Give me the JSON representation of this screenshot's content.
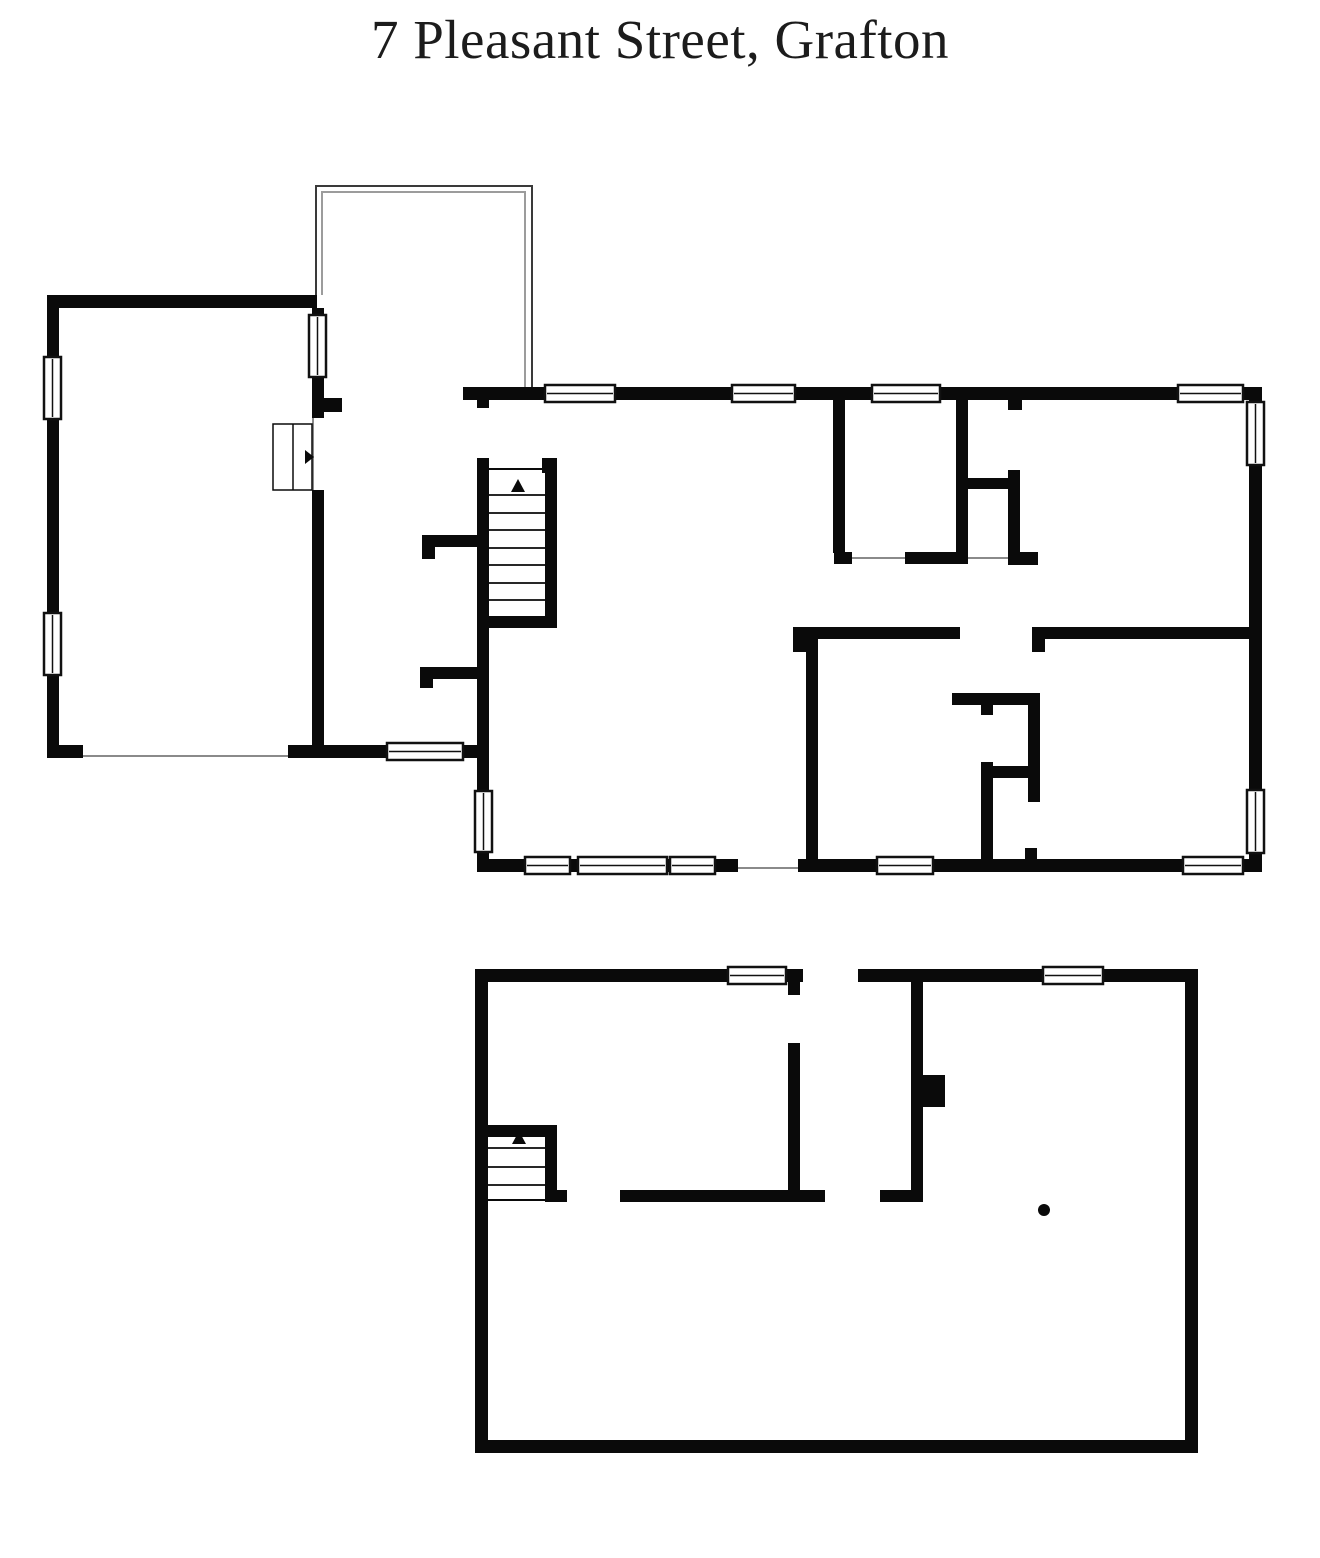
{
  "title": "7 Pleasant Street, Grafton",
  "colors": {
    "background": "#ffffff",
    "wall": "#0a0a0a",
    "window_fill": "#ffffff",
    "window_frame": "#111111",
    "thin_opening_line": "#8a8a8a",
    "porch_outer_line": "#3a3a3a",
    "porch_inner_line": "#9c9c9c",
    "marker": "#0a0a0a"
  },
  "icons": {
    "stairs_direction_marker": "up-triangle",
    "door_swing_marker": "right-triangle",
    "support_column_marker": "dot"
  },
  "plan": {
    "canvas": {
      "width": 1320,
      "height": 1558
    },
    "walls": [
      [
        47,
        295,
        270,
        13
      ],
      [
        47,
        295,
        12,
        463
      ],
      [
        47,
        745,
        36,
        13
      ],
      [
        288,
        745,
        37,
        13
      ],
      [
        312,
        308,
        12,
        110
      ],
      [
        312,
        490,
        12,
        268
      ],
      [
        312,
        398,
        30,
        14
      ],
      [
        463,
        387,
        799,
        13
      ],
      [
        1249,
        387,
        13,
        485
      ],
      [
        477,
        859,
        261,
        13
      ],
      [
        798,
        859,
        464,
        13
      ],
      [
        477,
        400,
        12,
        8
      ],
      [
        477,
        458,
        12,
        333
      ],
      [
        477,
        852,
        12,
        20
      ],
      [
        545,
        458,
        12,
        170
      ],
      [
        542,
        458,
        15,
        15
      ],
      [
        480,
        616,
        77,
        12
      ],
      [
        422,
        535,
        56,
        12
      ],
      [
        422,
        535,
        13,
        24
      ],
      [
        420,
        667,
        63,
        12
      ],
      [
        420,
        667,
        13,
        21
      ],
      [
        325,
        745,
        163,
        13
      ],
      [
        833,
        400,
        12,
        153
      ],
      [
        956,
        400,
        12,
        153
      ],
      [
        834,
        552,
        18,
        12
      ],
      [
        905,
        552,
        63,
        12
      ],
      [
        956,
        478,
        64,
        11
      ],
      [
        1008,
        470,
        12,
        83
      ],
      [
        1008,
        400,
        14,
        10
      ],
      [
        1008,
        552,
        30,
        13
      ],
      [
        793,
        627,
        167,
        12
      ],
      [
        793,
        627,
        13,
        25
      ],
      [
        1032,
        627,
        217,
        12
      ],
      [
        1032,
        627,
        13,
        25
      ],
      [
        806,
        633,
        12,
        227
      ],
      [
        952,
        693,
        88,
        12
      ],
      [
        981,
        705,
        12,
        10
      ],
      [
        1028,
        693,
        12,
        109
      ],
      [
        985,
        766,
        55,
        12
      ],
      [
        981,
        762,
        12,
        98
      ],
      [
        1025,
        848,
        12,
        12
      ],
      [
        475,
        969,
        13,
        483
      ],
      [
        475,
        969,
        328,
        13
      ],
      [
        858,
        969,
        340,
        13
      ],
      [
        1185,
        969,
        13,
        483
      ],
      [
        475,
        1440,
        723,
        13
      ],
      [
        788,
        982,
        12,
        13
      ],
      [
        788,
        1043,
        12,
        159
      ],
      [
        620,
        1190,
        205,
        12
      ],
      [
        911,
        982,
        12,
        208
      ],
      [
        880,
        1190,
        43,
        12
      ],
      [
        915,
        1075,
        30,
        32
      ],
      [
        487,
        1125,
        70,
        12
      ],
      [
        545,
        1125,
        12,
        73
      ],
      [
        545,
        1190,
        22,
        12
      ]
    ],
    "windows": [
      {
        "x": 44,
        "y": 357,
        "w": 17,
        "h": 62,
        "o": "v"
      },
      {
        "x": 44,
        "y": 613,
        "w": 17,
        "h": 62,
        "o": "v"
      },
      {
        "x": 309,
        "y": 315,
        "w": 17,
        "h": 62,
        "o": "v"
      },
      {
        "x": 545,
        "y": 385,
        "w": 70,
        "h": 17,
        "o": "h"
      },
      {
        "x": 732,
        "y": 385,
        "w": 63,
        "h": 17,
        "o": "h"
      },
      {
        "x": 872,
        "y": 385,
        "w": 68,
        "h": 17,
        "o": "h"
      },
      {
        "x": 1178,
        "y": 385,
        "w": 65,
        "h": 17,
        "o": "h"
      },
      {
        "x": 1247,
        "y": 402,
        "w": 17,
        "h": 63,
        "o": "v"
      },
      {
        "x": 1247,
        "y": 790,
        "w": 17,
        "h": 63,
        "o": "v"
      },
      {
        "x": 525,
        "y": 857,
        "w": 45,
        "h": 17,
        "o": "h"
      },
      {
        "x": 578,
        "y": 857,
        "w": 89,
        "h": 17,
        "o": "h"
      },
      {
        "x": 670,
        "y": 857,
        "w": 45,
        "h": 17,
        "o": "h"
      },
      {
        "x": 877,
        "y": 857,
        "w": 56,
        "h": 17,
        "o": "h"
      },
      {
        "x": 1183,
        "y": 857,
        "w": 60,
        "h": 17,
        "o": "h"
      },
      {
        "x": 475,
        "y": 791,
        "w": 17,
        "h": 61,
        "o": "v"
      },
      {
        "x": 387,
        "y": 743,
        "w": 76,
        "h": 17,
        "o": "h"
      },
      {
        "x": 728,
        "y": 967,
        "w": 58,
        "h": 17,
        "o": "h"
      },
      {
        "x": 1043,
        "y": 967,
        "w": 60,
        "h": 17,
        "o": "h"
      }
    ],
    "door_boxes": [
      {
        "x": 273,
        "y": 424,
        "w": 39,
        "h": 66,
        "divider_x": 293
      }
    ],
    "thin_lines": [
      {
        "x1": 83,
        "y1": 756,
        "x2": 288,
        "y2": 756,
        "c": "thin"
      },
      {
        "x1": 313,
        "y1": 418,
        "x2": 313,
        "y2": 490,
        "c": "thin"
      },
      {
        "x1": 738,
        "y1": 868,
        "x2": 798,
        "y2": 868,
        "c": "thin"
      },
      {
        "x1": 852,
        "y1": 558,
        "x2": 905,
        "y2": 558,
        "c": "thin"
      },
      {
        "x1": 968,
        "y1": 558,
        "x2": 1008,
        "y2": 558,
        "c": "thin"
      },
      {
        "x1": 489,
        "y1": 469,
        "x2": 542,
        "y2": 469,
        "c": "dark"
      },
      {
        "x1": 488,
        "y1": 1200,
        "x2": 545,
        "y2": 1200,
        "c": "dark"
      }
    ],
    "polylines": [
      {
        "points": [
          [
            316,
            295
          ],
          [
            316,
            186
          ],
          [
            532,
            186
          ],
          [
            532,
            387
          ]
        ],
        "c": "porch_outer"
      },
      {
        "points": [
          [
            322,
            295
          ],
          [
            322,
            192
          ],
          [
            525,
            192
          ],
          [
            525,
            387
          ]
        ],
        "c": "porch_inner"
      }
    ],
    "treads": [
      {
        "x1": 489,
        "x2": 545,
        "ys": [
          495,
          513,
          530,
          548,
          565,
          583,
          600
        ]
      },
      {
        "x1": 488,
        "x2": 545,
        "ys": [
          1148,
          1167,
          1185
        ]
      }
    ],
    "triangles": [
      {
        "points": [
          [
            305,
            450
          ],
          [
            305,
            464
          ],
          [
            314,
            457
          ]
        ],
        "kind": "door-swing"
      },
      {
        "points": [
          [
            511,
            492
          ],
          [
            525,
            492
          ],
          [
            518,
            479
          ]
        ],
        "kind": "stairs-up"
      },
      {
        "points": [
          [
            512,
            1144
          ],
          [
            526,
            1144
          ],
          [
            519,
            1131
          ]
        ],
        "kind": "stairs-up"
      }
    ],
    "circles": [
      {
        "cx": 1044,
        "cy": 1210,
        "r": 6
      }
    ]
  }
}
